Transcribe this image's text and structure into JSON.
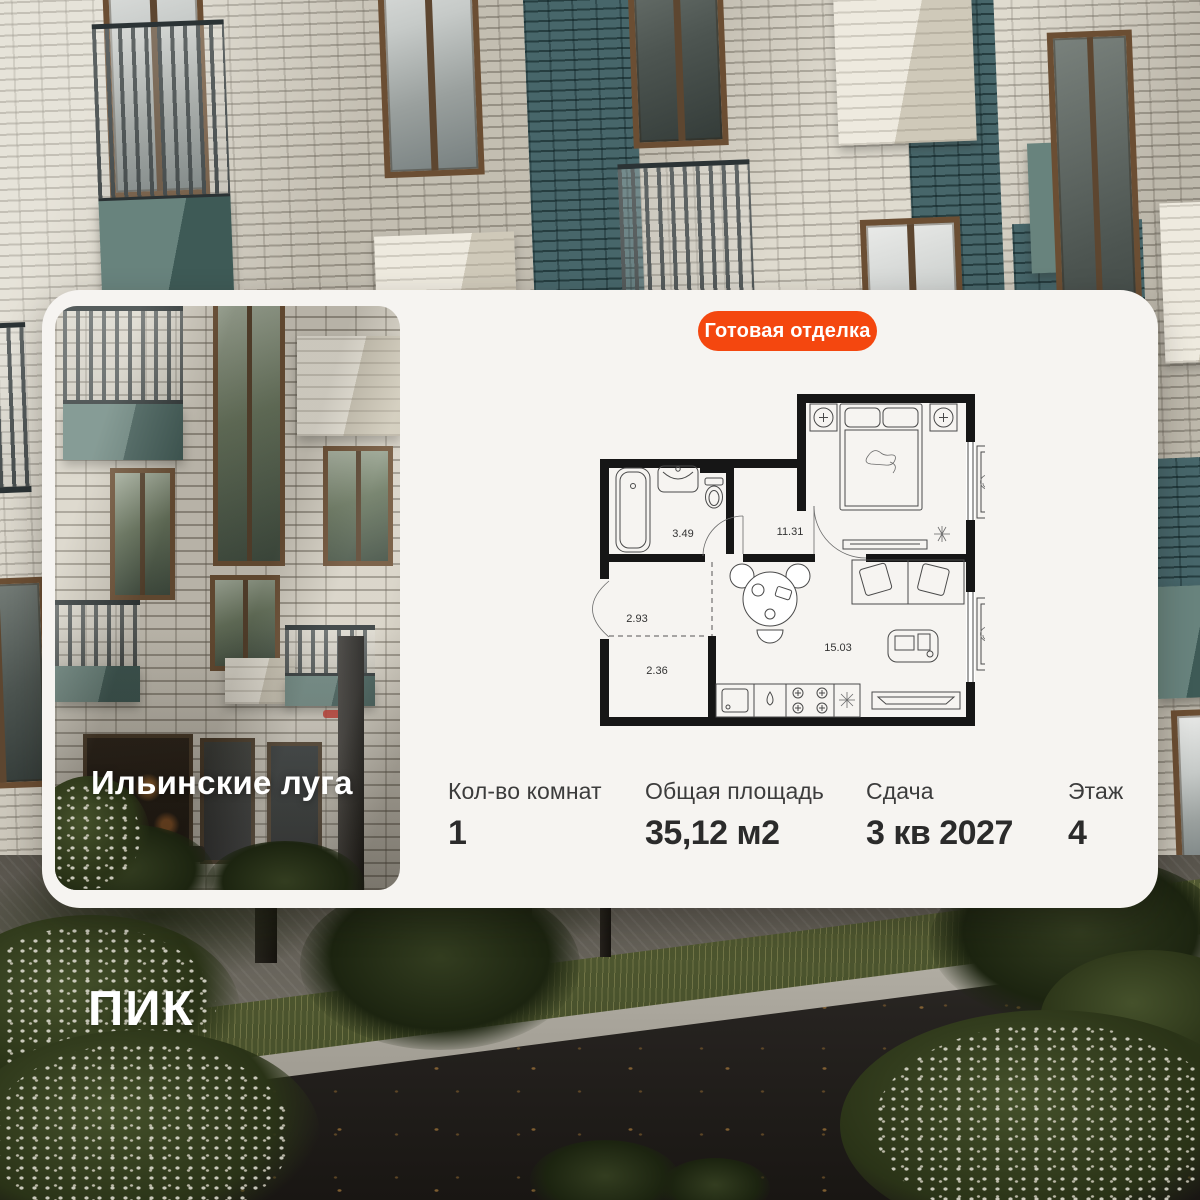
{
  "colors": {
    "accent_orange": "#f4470f",
    "card_bg": "#f6f4f1"
  },
  "badge": {
    "label": "Готовая отделка"
  },
  "project": {
    "name": "Ильинские луга"
  },
  "brand": {
    "logo": "ПИК"
  },
  "floor_plan": {
    "rooms": [
      {
        "id": "bathroom",
        "area": "3.49"
      },
      {
        "id": "bedroom",
        "area": "11.31"
      },
      {
        "id": "hallway",
        "area": "2.93"
      },
      {
        "id": "wardrobe",
        "area": "2.36"
      },
      {
        "id": "living-kitchen",
        "area": "15.03"
      }
    ]
  },
  "details": {
    "items": [
      {
        "label": "Кол-во комнат",
        "value": "1"
      },
      {
        "label": "Общая площадь",
        "value": "35,12 м2"
      },
      {
        "label": "Сдача",
        "value": "3 кв 2027"
      },
      {
        "label": "Этаж",
        "value": "4"
      }
    ]
  }
}
